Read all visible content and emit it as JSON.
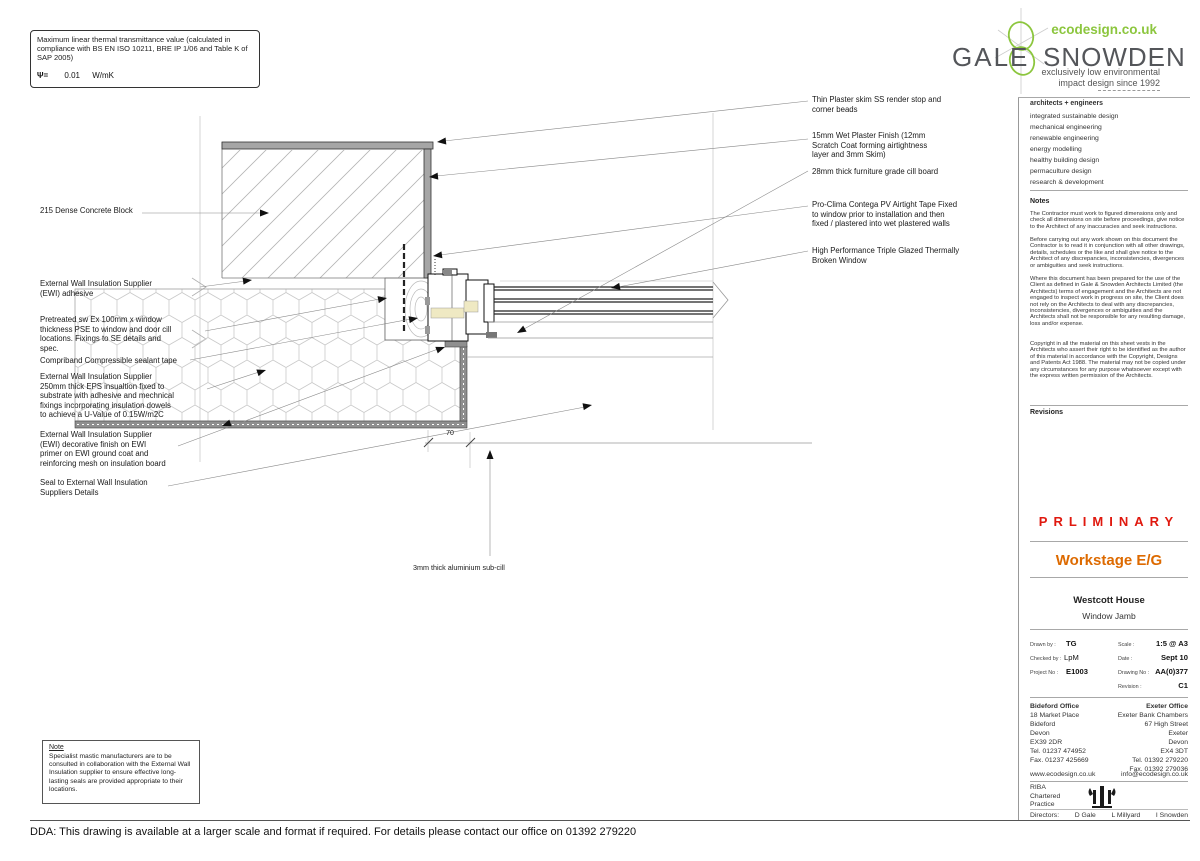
{
  "thermal_box": {
    "text": "Maximum linear thermal transmittance value (calculated in compliance with BS EN ISO 10211, BRE IP 1/06 and Table K of SAP 2005)",
    "symbol": "Ψ=",
    "value": "0.01",
    "unit": "W/mK"
  },
  "logo": {
    "name_left": "GALE",
    "name_right": "SNOWDEN",
    "url": "ecodesign.co.uk",
    "tagline_line1": "exclusively low environmental",
    "tagline_line2": "impact design since 1992",
    "green": "#8cc63e"
  },
  "services": {
    "header": "architects + engineers",
    "items": [
      "integrated sustainable design",
      "mechanical engineering",
      "renewable engineering",
      "energy modelling",
      "healthy building design",
      "permaculture design",
      "research & development"
    ]
  },
  "notes": {
    "header": "Notes",
    "paragraphs": [
      "The Contractor must work to figured dimensions only and check all dimensions on site before proceedings, give notice to the Architect of any inaccuracies and seek instructions.",
      "Before carrying out any work shown on this document the Contractor is to read it in conjunction with all other drawings, details, schedules or the like and shall give notice to the Architect of any discrepancies, inconsistencies, divergences or ambiguities and seek instructions.",
      "Where this document has been prepared for the use of the Client as defined in Gale & Snowden Architects Limited (the Architects) terms of engagement and the Architects are not engaged to inspect work in progress on site, the Client does not rely on the Architects to deal with any discrepancies, inconsistencies, divergences or ambiguities and the Architects shall not be responsible for any resulting damage, loss and/or expense.",
      "Copyright in all the material on this sheet vests in the Architects who assert their right to be identified as the author of this material in accordance with the Copyright, Designs and Patents Act 1988. The material may not be copied under any circumstances for any purpose whatsoever except with the express written permission of the Architects."
    ]
  },
  "revisions_header": "Revisions",
  "status": {
    "preliminary": "PRLIMINARY",
    "workstage": "Workstage E/G"
  },
  "project": {
    "name": "Westcott House",
    "drawing_title": "Window Jamb"
  },
  "title_block": {
    "drawn_by_label": "Drawn by :",
    "drawn_by": "TG",
    "checked_by_label": "Checked by :",
    "checked_by": "LpM",
    "project_no_label": "Project No :",
    "project_no": "E1003",
    "scale_label": "Scale :",
    "scale": "1:5 @ A3",
    "date_label": "Date :",
    "date": "Sept 10",
    "drawing_no_label": "Drawing No :",
    "drawing_no": "AA(0)377",
    "revision_label": "Revision :",
    "revision": "C1"
  },
  "offices": {
    "bideford_name": "Bideford Office",
    "bideford_lines": "18 Market Place\nBideford\nDevon\nEX39 2DR\nTel. 01237 474952\nFax. 01237 425669",
    "exeter_name": "Exeter Office",
    "exeter_lines": "Exeter Bank Chambers\n67 High Street\nExeter\nDevon\nEX4 3DT\nTel. 01392 279220\nFax. 01392 279036",
    "web": "www.ecodesign.co.uk",
    "email": "info@ecodesign.co.uk"
  },
  "riba": {
    "lines": "RIBA\nChartered\nPractice"
  },
  "directors": {
    "label": "Directors:",
    "names": [
      "D  Gale",
      "L  Millyard",
      "I  Snowden"
    ]
  },
  "annotations": {
    "left": [
      {
        "text": "215 Dense Concrete Block"
      },
      {
        "text": "External Wall Insulation Supplier\n(EWI) adhesive"
      },
      {
        "text": "Pretreated sw Ex 100mm x window\nthickness PSE to window and door cill\nlocations. Fixings to  SE details and\nspec."
      },
      {
        "text": "Compriband Compressible sealant tape"
      },
      {
        "text": "External Wall Insulation Supplier\n250mm thick EPS insualtion fixed to\nsubstrate with adhesive and mechnical\nfixings incorporating insulation dowels\nto achieve a U-Value of 0.15W/m2C"
      },
      {
        "text": "External Wall Insulation Supplier\n(EWI) decorative finish on EWI\nprimer on EWI ground coat and\nreinforcing mesh on insulation board"
      },
      {
        "text": "Seal to External Wall Insulation\nSuppliers Details"
      }
    ],
    "right": [
      {
        "text": "Thin Plaster skim SS render stop and\ncorner beads"
      },
      {
        "text": "15mm Wet Plaster Finish (12mm\nScratch Coat forming airtightness\nlayer and 3mm Skim)"
      },
      {
        "text": "28mm thick furniture grade cill board"
      },
      {
        "text": "Pro-Clima Contega PV Airtight Tape Fixed\nto window prior to installation and then\nfixed / plastered into wet plastered walls"
      },
      {
        "text": "High Performance Triple Glazed Thermally\nBroken Window"
      }
    ],
    "subcill": "3mm thick aluminium sub-cill",
    "dimension": "70"
  },
  "note_box": {
    "title": "Note",
    "text": "Specialist mastic manufacturers are to be consulted in collaboration with the External Wall Insulation supplier to ensure effective long-lasting seals are provided appropriate to their locations."
  },
  "dda": "DDA: This drawing is available at a larger scale and format if required. For details please contact our office on 01392 279220",
  "colors": {
    "preliminary_red": "#e0190f",
    "workstage_orange": "#dd6a00",
    "logo_green": "#8cc63e",
    "plaster_gray": "#a6a6a6",
    "render_gray": "#8f8f8f",
    "timber_cream": "#efe9c3"
  }
}
